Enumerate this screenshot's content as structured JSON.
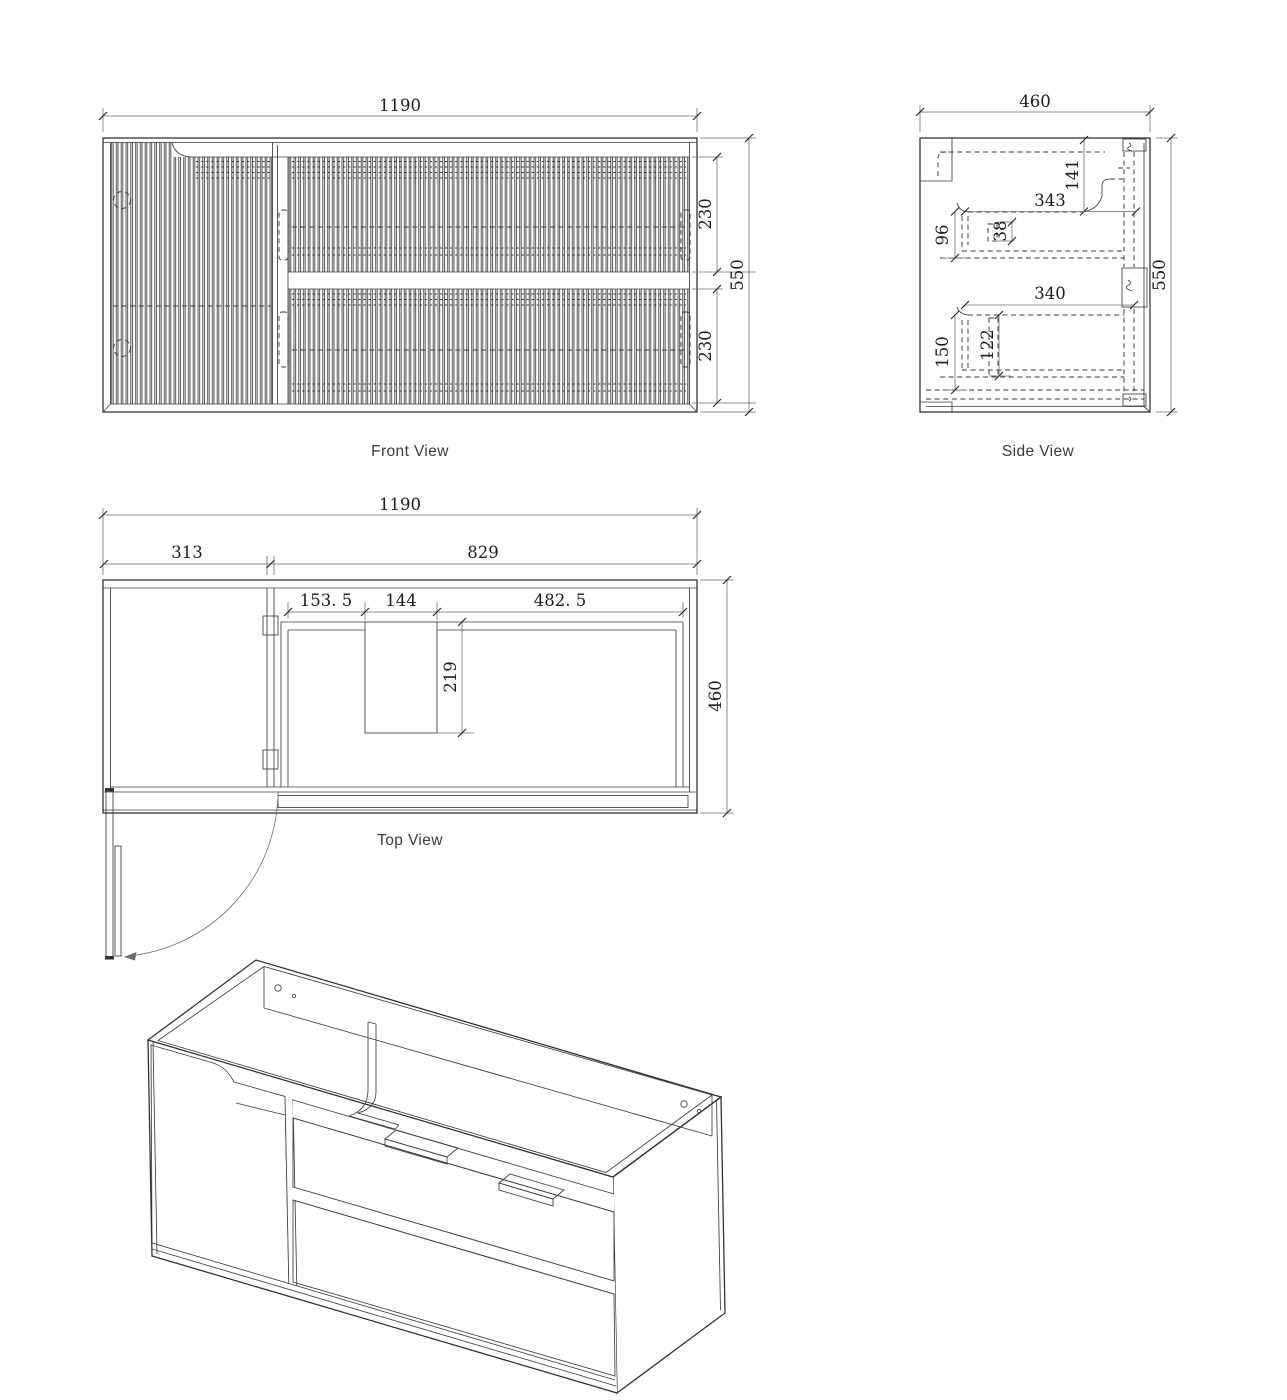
{
  "front_view": {
    "label": "Front View",
    "width": "1190",
    "upper_drawer_height": "230",
    "lower_drawer_height": "230",
    "height": "550"
  },
  "side_view": {
    "label": "Side View",
    "depth": "460",
    "height": "550",
    "recess_height": "141",
    "upper_drawer_depth": "343",
    "runner_offset": "96",
    "rail_thickness": "38",
    "lower_drawer_depth": "340",
    "lower_offset": "150",
    "drawer_inner_height": "122"
  },
  "top_view": {
    "label": "Top View",
    "width": "1190",
    "door_width": "313",
    "drawer_section_width": "829",
    "cutout_left_offset": "153. 5",
    "cutout_width": "144",
    "cutout_right_offset": "482. 5",
    "cutout_depth": "219",
    "depth": "460"
  }
}
